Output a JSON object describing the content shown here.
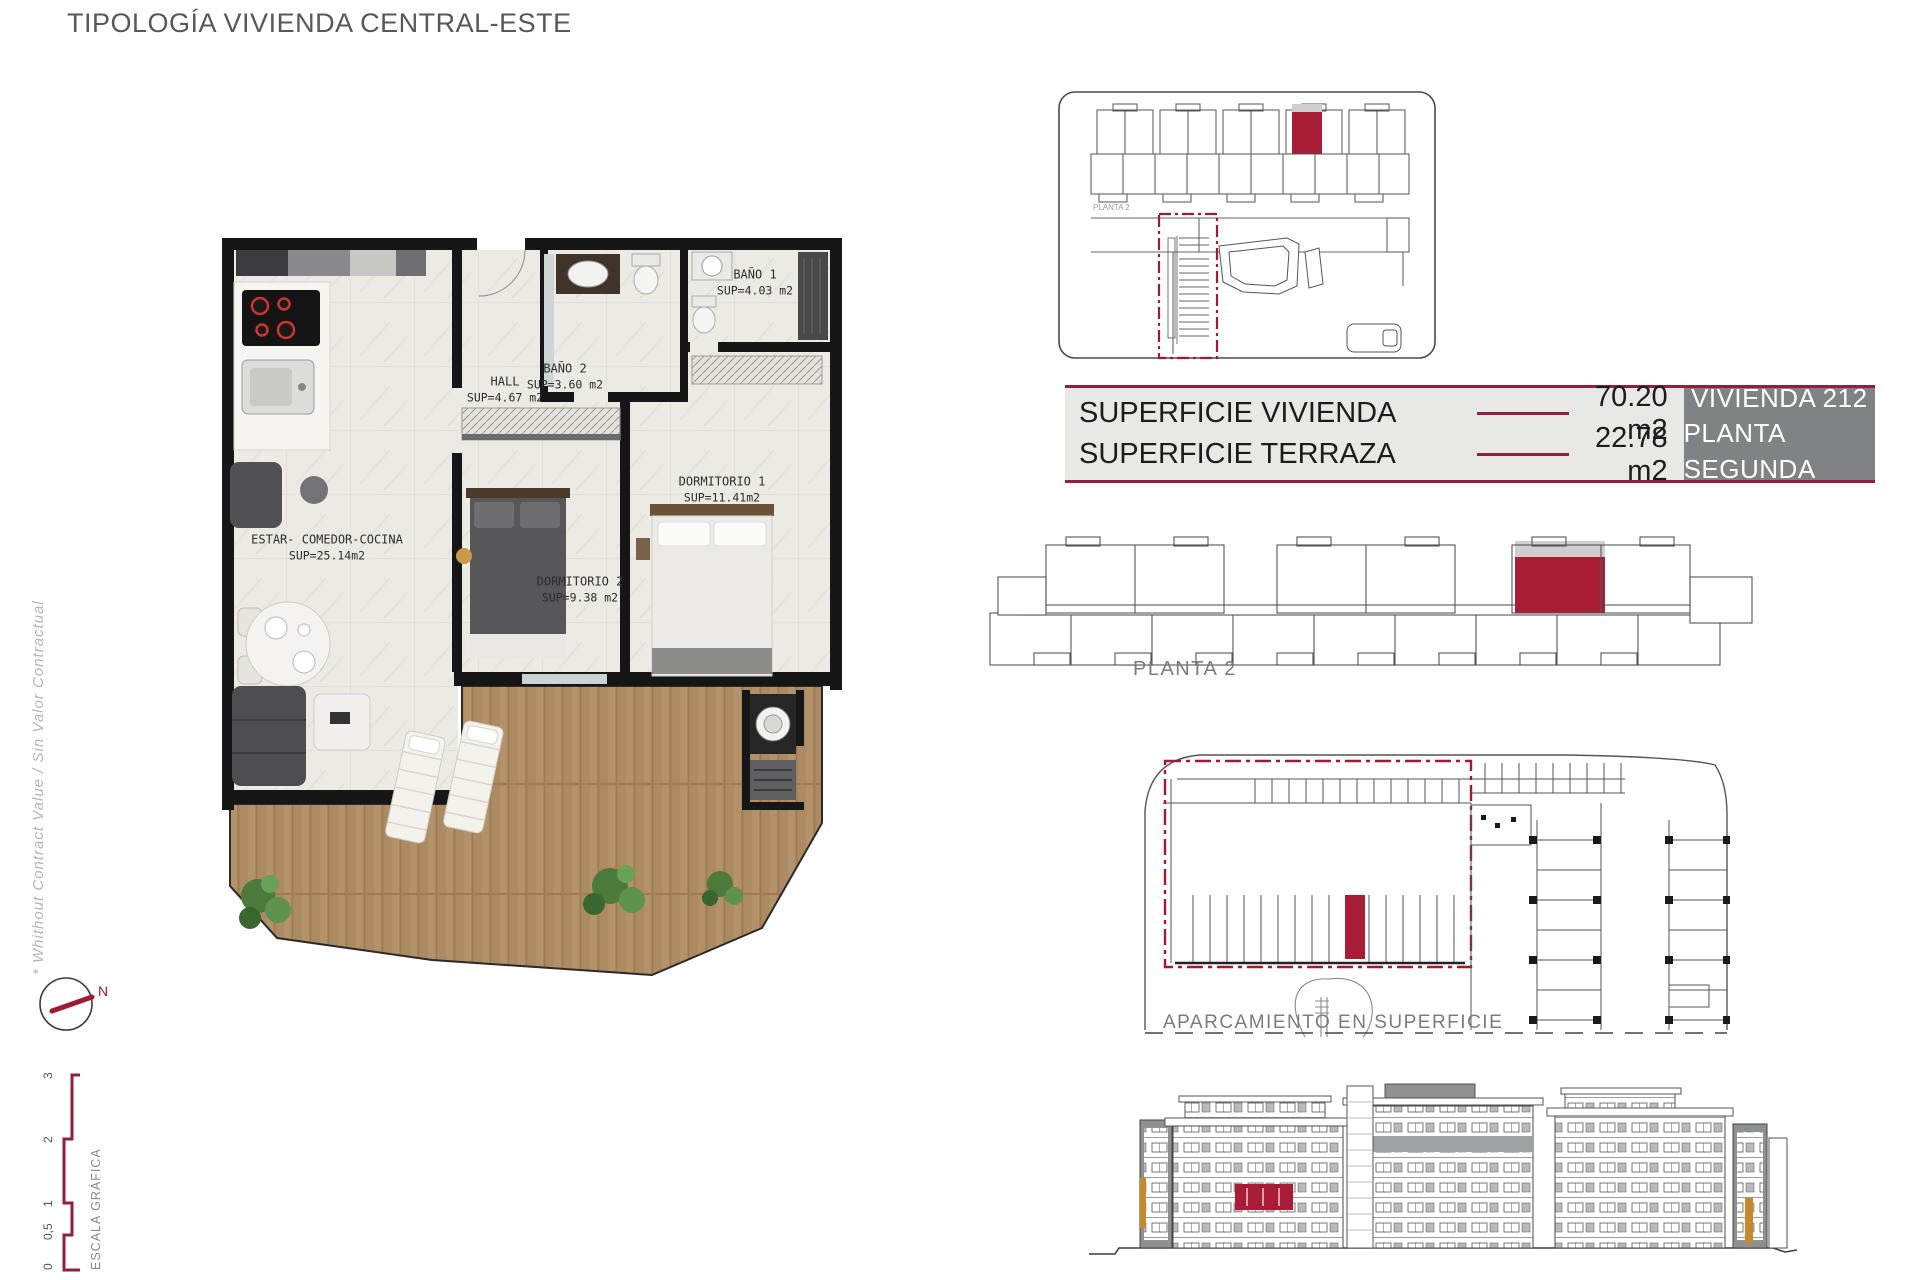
{
  "title": "TIPOLOGÍA VIVIENDA CENTRAL-ESTE",
  "side_note": "* Whithout Contract Value / Sin Valor Contractual",
  "colors": {
    "accent": "#9E1B32",
    "highlight": "#A81D35",
    "muted": "#7B7C7E"
  },
  "floor_plan": {
    "rooms": {
      "bano1": {
        "name": "BAÑO 1",
        "sup": "SUP=4.03 m2"
      },
      "bano2": {
        "name": "BAÑO 2",
        "sup": "SUP=3.60 m2"
      },
      "hall": {
        "name": "HALL",
        "sup": "SUP=4.67 m2"
      },
      "dormitorio1": {
        "name": "DORMITORIO 1",
        "sup": "SUP=11.41m2"
      },
      "dormitorio2": {
        "name": "DORMITORIO 2",
        "sup": "SUP=9.38 m2"
      },
      "estar": {
        "name": "ESTAR- COMEDOR-COCINA",
        "sup": "SUP=25.14m2"
      }
    }
  },
  "compass": {
    "north_label": "N"
  },
  "scale_bar": {
    "title": "ESCALA GRÁFICA",
    "ticks": [
      "0",
      "0,5",
      "1",
      "2",
      "3"
    ]
  },
  "site_plan": {
    "label": "PLANTA 2"
  },
  "summary": {
    "rows": [
      {
        "label": "SUPERFICIE VIVIENDA",
        "value": "70.20 m2"
      },
      {
        "label": "SUPERFICIE TERRAZA",
        "value": "22.78 m2"
      }
    ],
    "unit_line1": "VIVIENDA 212",
    "unit_line2": "PLANTA SEGUNDA"
  },
  "planta2": {
    "label": "PLANTA 2"
  },
  "parking": {
    "label": "APARCAMIENTO EN SUPERFICIE"
  }
}
